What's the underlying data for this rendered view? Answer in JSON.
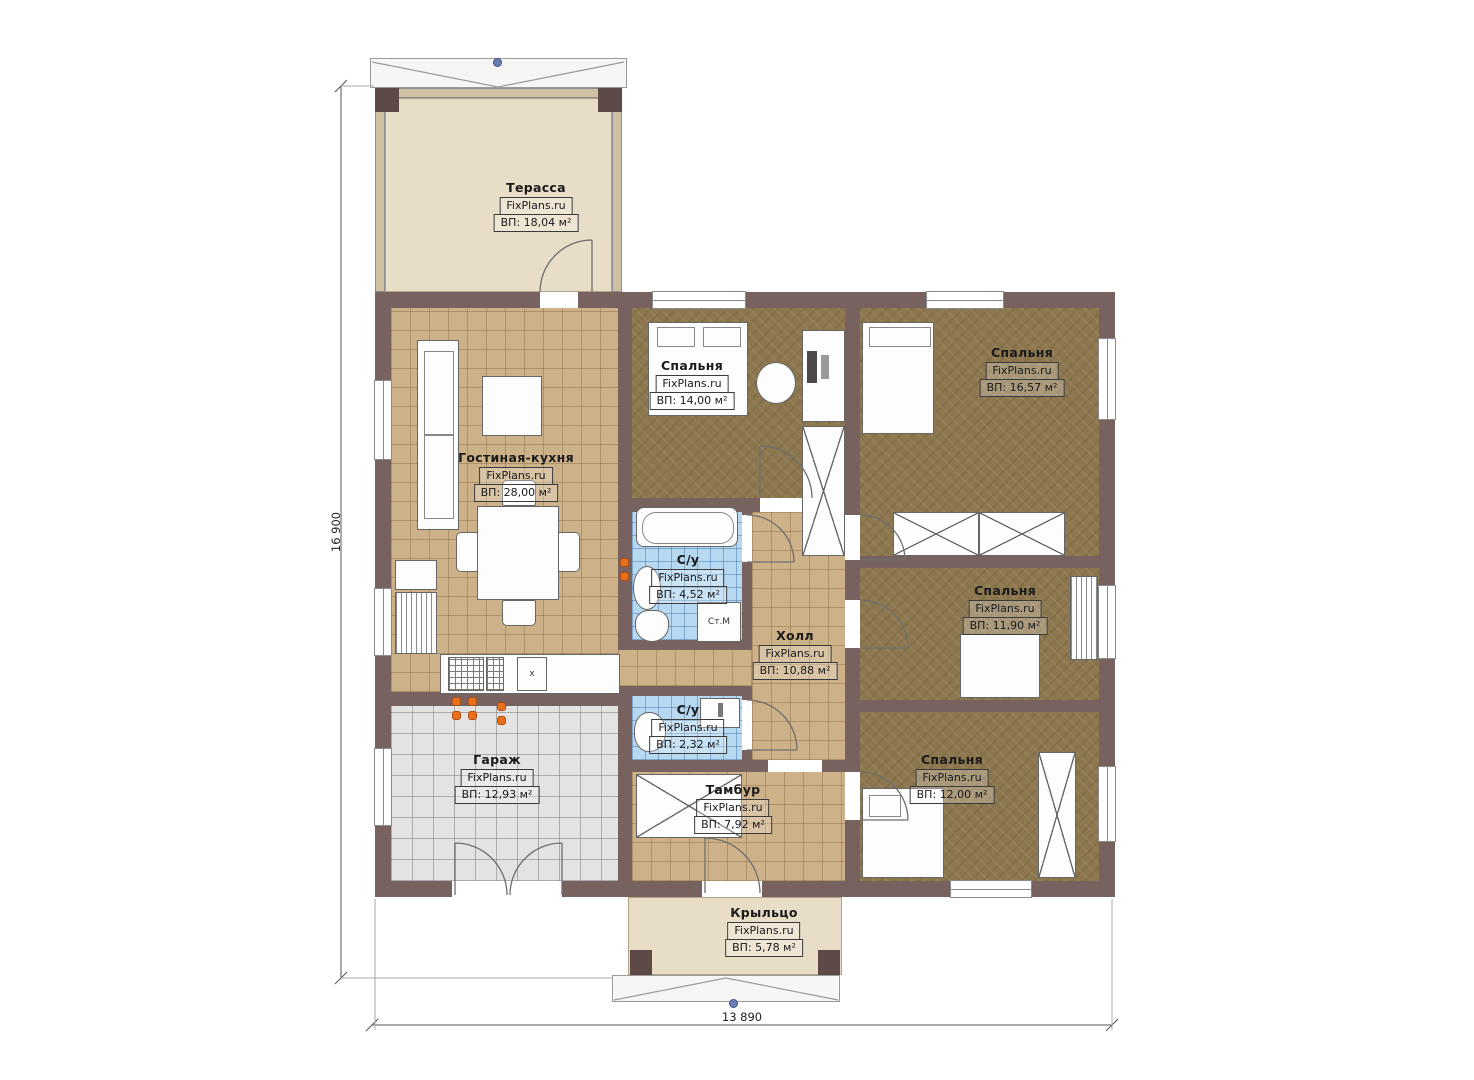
{
  "brand": "FixPlans.ru",
  "rooms": [
    {
      "id": "terrace",
      "name": "Терасса",
      "area": "ВП: 18,04 м²"
    },
    {
      "id": "living-kitchen",
      "name": "Гостиная-кухня",
      "area": "ВП: 28,00 м²"
    },
    {
      "id": "bedroom-1",
      "name": "Спальня",
      "area": "ВП: 14,00 м²"
    },
    {
      "id": "bedroom-2",
      "name": "Спальня",
      "area": "ВП: 16,57 м²"
    },
    {
      "id": "bathroom-1",
      "name": "С/у",
      "area": "ВП: 4,52 м²"
    },
    {
      "id": "hall",
      "name": "Холл",
      "area": "ВП: 10,88 м²"
    },
    {
      "id": "bedroom-3",
      "name": "Спальня",
      "area": "ВП: 11,90 м²"
    },
    {
      "id": "bathroom-2",
      "name": "С/у",
      "area": "ВП: 2,32 м²"
    },
    {
      "id": "garage",
      "name": "Гараж",
      "area": "ВП: 12,93 м²"
    },
    {
      "id": "vestibule",
      "name": "Тамбур",
      "area": "ВП: 7,92 м²"
    },
    {
      "id": "bedroom-4",
      "name": "Спальня",
      "area": "ВП: 12,00 м²"
    },
    {
      "id": "porch",
      "name": "Крыльцо",
      "area": "ВП: 5,78 м²"
    }
  ],
  "dimensions": {
    "left": "16 900",
    "bottom": "13 890"
  },
  "annotations": {
    "washing_machine": "Ст.М",
    "kitchen_mark": "x"
  },
  "colors": {
    "wall": "#77625f",
    "pillar": "#5e4949",
    "tile_floor": "#cdb189",
    "bedroom_floor": "#8d774e",
    "bathroom_floor": "#b7d8f1",
    "garage_floor": "#e3e3e3",
    "terrace_floor": "#e8ddc7",
    "accent_dot": "#e8701a",
    "handle": "#6c7fb4"
  }
}
